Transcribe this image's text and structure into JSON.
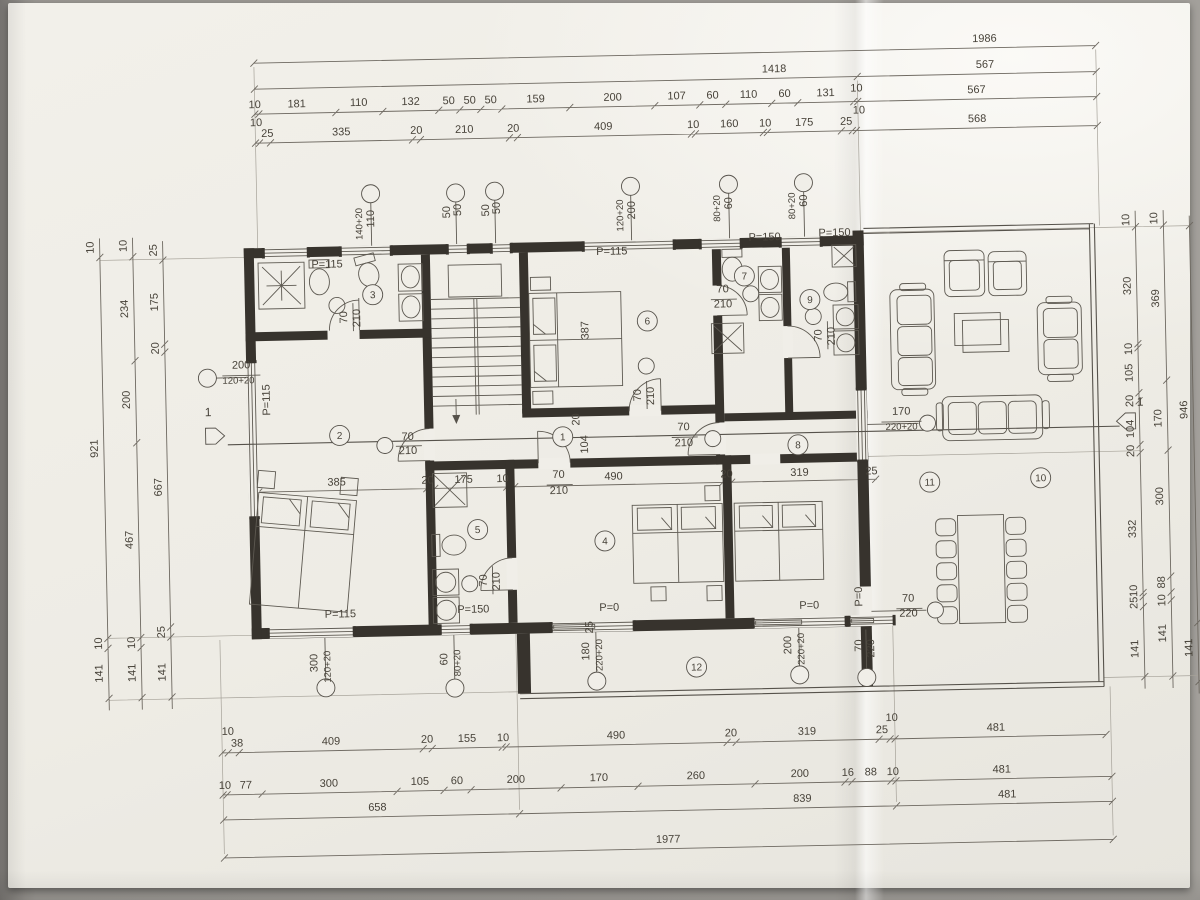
{
  "drawing": {
    "type": "architectural-floor-plan",
    "paper_color": "#f0eee8",
    "ink_color": "#474239",
    "wall_color": "#37332d",
    "section_mark": "1",
    "room_numbers": [
      [
        "1",
        563,
        436
      ],
      [
        "2",
        340,
        430
      ],
      [
        "3",
        376,
        290
      ],
      [
        "4",
        603,
        541
      ],
      [
        "5",
        476,
        527
      ],
      [
        "6",
        650,
        322
      ],
      [
        "7",
        748,
        279
      ],
      [
        "8",
        798,
        449
      ],
      [
        "9",
        813,
        304
      ],
      [
        "10",
        1040,
        487
      ],
      [
        "11",
        929,
        489
      ],
      [
        "12",
        692,
        669
      ]
    ],
    "texts": {
      "top": [
        [
          "1986",
          993,
          50
        ],
        [
          "1418",
          782,
          76
        ],
        [
          "567",
          993,
          76
        ],
        [
          "10",
          262,
          101
        ],
        [
          "181",
          304,
          101
        ],
        [
          "110",
          366,
          101
        ],
        [
          "132",
          418,
          101
        ],
        [
          "50",
          456,
          101
        ],
        [
          "50",
          477,
          101
        ],
        [
          "50",
          498,
          101
        ],
        [
          "159",
          543,
          101
        ],
        [
          "200",
          620,
          101
        ],
        [
          "107",
          684,
          101
        ],
        [
          "60",
          720,
          101
        ],
        [
          "110",
          756,
          101
        ],
        [
          "60",
          792,
          101
        ],
        [
          "131",
          833,
          101
        ],
        [
          "10",
          864,
          97
        ],
        [
          "567",
          984,
          101
        ],
        [
          "10",
          263,
          119
        ],
        [
          "25",
          274,
          130
        ],
        [
          "335",
          348,
          130
        ],
        [
          "20",
          423,
          130
        ],
        [
          "210",
          471,
          130
        ],
        [
          "20",
          520,
          130
        ],
        [
          "409",
          610,
          130
        ],
        [
          "10",
          700,
          130
        ],
        [
          "160",
          736,
          130
        ],
        [
          "10",
          772,
          130
        ],
        [
          "175",
          811,
          130
        ],
        [
          "25",
          853,
          130
        ],
        [
          "10",
          866,
          119
        ],
        [
          "568",
          984,
          130
        ]
      ],
      "bottom": [
        [
          "10",
          222,
          727
        ],
        [
          "38",
          231,
          739
        ],
        [
          "409",
          325,
          739
        ],
        [
          "20",
          421,
          739
        ],
        [
          "155",
          461,
          739
        ],
        [
          "10",
          497,
          739
        ],
        [
          "490",
          610,
          739
        ],
        [
          "20",
          725,
          739
        ],
        [
          "319",
          801,
          739
        ],
        [
          "25",
          876,
          739
        ],
        [
          "10",
          886,
          727
        ],
        [
          "481",
          990,
          739
        ],
        [
          "10",
          218,
          781
        ],
        [
          "77",
          239,
          781
        ],
        [
          "300",
          322,
          781
        ],
        [
          "105",
          413,
          781
        ],
        [
          "60",
          450,
          781
        ],
        [
          "200",
          509,
          781
        ],
        [
          "170",
          592,
          781
        ],
        [
          "260",
          689,
          781
        ],
        [
          "200",
          793,
          781
        ],
        [
          "16",
          841,
          781
        ],
        [
          "88",
          864,
          781
        ],
        [
          "10",
          886,
          781
        ],
        [
          "481",
          995,
          781
        ],
        [
          "658",
          370,
          806
        ],
        [
          "839",
          795,
          806
        ],
        [
          "481",
          1000,
          806
        ],
        [
          "1977",
          660,
          844
        ]
      ],
      "left": [
        [
          "10",
          98,
          237
        ],
        [
          "921",
          98,
          438
        ],
        [
          "10",
          98,
          633
        ],
        [
          "141",
          98,
          663
        ],
        [
          "10",
          131,
          236
        ],
        [
          "234",
          131,
          299
        ],
        [
          "200",
          131,
          390
        ],
        [
          "467",
          131,
          530
        ],
        [
          "10",
          131,
          633
        ],
        [
          "141",
          131,
          663
        ],
        [
          "25",
          161,
          241
        ],
        [
          "175",
          161,
          293
        ],
        [
          "20",
          161,
          339
        ],
        [
          "667",
          161,
          478
        ],
        [
          "25",
          161,
          623
        ],
        [
          "141",
          161,
          663
        ]
      ],
      "right": [
        [
          "10",
          1134,
          231
        ],
        [
          "320",
          1134,
          297
        ],
        [
          "10",
          1134,
          360
        ],
        [
          "105",
          1134,
          384
        ],
        [
          "20",
          1134,
          412
        ],
        [
          "104",
          1134,
          440
        ],
        [
          "20",
          1134,
          462
        ],
        [
          "332",
          1134,
          540
        ],
        [
          "10",
          1134,
          602
        ],
        [
          "25",
          1134,
          614
        ],
        [
          "141",
          1134,
          660
        ],
        [
          "10",
          1162,
          230
        ],
        [
          "369",
          1162,
          310
        ],
        [
          "170",
          1162,
          430
        ],
        [
          "300",
          1162,
          508
        ],
        [
          "88",
          1162,
          594
        ],
        [
          "10",
          1162,
          612
        ],
        [
          "141",
          1162,
          645
        ],
        [
          "946",
          1188,
          422
        ],
        [
          "141",
          1188,
          660
        ]
      ],
      "inner": [
        [
          "385",
          336,
          480
        ],
        [
          "20",
          427,
          480
        ],
        [
          "175",
          463,
          480
        ],
        [
          "10",
          502,
          480
        ],
        [
          "490",
          613,
          480
        ],
        [
          "20",
          726,
          480
        ],
        [
          "319",
          799,
          480
        ],
        [
          "25",
          871,
          480
        ]
      ],
      "plan": [
        [
          "P=115",
          331,
          262
        ],
        [
          "P=115",
          616,
          255
        ],
        [
          "P=115",
          337,
          612
        ],
        [
          "P=150",
          769,
          244
        ],
        [
          "P=150",
          839,
          241
        ],
        [
          "P=150",
          470,
          610
        ],
        [
          "P=0",
          606,
          611
        ],
        [
          "P=0",
          806,
          613
        ],
        [
          "70",
          408,
          436
        ],
        [
          "210",
          408,
          450
        ],
        [
          "70",
          684,
          432
        ],
        [
          "210",
          684,
          448
        ],
        [
          "70",
          726,
          295
        ],
        [
          "210",
          726,
          310
        ],
        [
          "70",
          558,
          477
        ],
        [
          "210",
          558,
          493
        ],
        [
          "170",
          902,
          421
        ],
        [
          "220+20",
          902,
          436,
          9.5
        ],
        [
          "70",
          905,
          608
        ],
        [
          "220",
          905,
          623
        ],
        [
          "200",
          243,
          361
        ],
        [
          "120+20",
          240,
          376,
          9.5
        ]
      ],
      "planv": [
        [
          "P=115",
          271,
          393
        ],
        [
          "387",
          591,
          330
        ],
        [
          "104",
          588,
          444
        ],
        [
          "20",
          580,
          419
        ],
        [
          "P=0",
          859,
          602
        ],
        [
          "70",
          350,
          312
        ],
        [
          "210",
          363,
          313
        ],
        [
          "70",
          642,
          396
        ],
        [
          "210",
          655,
          397
        ],
        [
          "70",
          824,
          340
        ],
        [
          "210",
          837,
          341
        ],
        [
          "70",
          484,
          578
        ],
        [
          "210",
          497,
          579
        ],
        [
          "25",
          589,
          627
        ],
        [
          "300",
          313,
          657
        ],
        [
          "120+20",
          326,
          661,
          9.5
        ],
        [
          "60",
          443,
          656
        ],
        [
          "80+20",
          456,
          660,
          9.5
        ],
        [
          "180",
          585,
          651
        ],
        [
          "220+20",
          598,
          655,
          9.5
        ],
        [
          "200",
          787,
          649
        ],
        [
          "220+20",
          800,
          653,
          9.5
        ],
        [
          "70",
          858,
          651
        ],
        [
          "220",
          870,
          654
        ],
        [
          "110",
          379,
          214
        ],
        [
          "140+20",
          367,
          219,
          9.5
        ],
        [
          "50",
          466,
          207
        ],
        [
          "50",
          455,
          209
        ],
        [
          "50",
          505,
          206
        ],
        [
          "50",
          494,
          208
        ],
        [
          "200",
          640,
          211
        ],
        [
          "120+20",
          628,
          216,
          9.5
        ],
        [
          "60",
          737,
          206
        ],
        [
          "80+20",
          725,
          211,
          9.5
        ],
        [
          "60",
          812,
          205
        ],
        [
          "80+20",
          800,
          210,
          9.5
        ]
      ],
      "section": [
        [
          "1",
          209,
          408
        ],
        [
          "1",
          1141,
          417
        ]
      ]
    }
  }
}
